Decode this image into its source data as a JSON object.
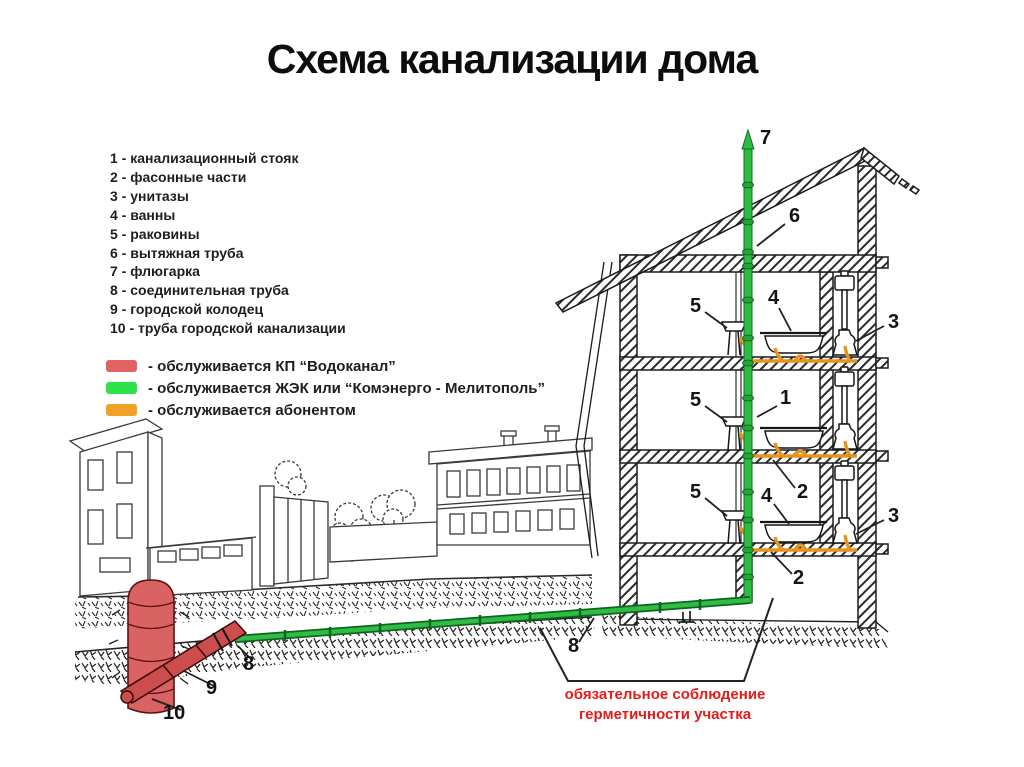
{
  "title": "Схема канализации дома",
  "legend": {
    "items": [
      "1 - канализационный стояк",
      "2 - фасонные части",
      "3 - унитазы",
      "4 - ванны",
      "5 - раковины",
      "6 - вытяжная труба",
      "7 - флюгарка",
      "8 - соединительная труба",
      "9 - городской колодец",
      "10 - труба городской канализации"
    ]
  },
  "service_legend": {
    "items": [
      {
        "color": "#e06262",
        "label": "- обслуживается КП “Водоканал”"
      },
      {
        "color": "#2ee24a",
        "label": "- обслуживается ЖЭК или “Комэнерго - Мелитополь”"
      },
      {
        "color": "#f0a226",
        "label": "- обслуживается абонентом"
      }
    ]
  },
  "numbers": {
    "n1": "1",
    "n2": "2",
    "n3": "3",
    "n4": "4",
    "n5": "5",
    "n6": "6",
    "n7": "7",
    "n8": "8",
    "n9": "9",
    "n10": "10"
  },
  "caption": {
    "line1": "обязательное соблюдение",
    "line2": "герметичности участка"
  },
  "colors": {
    "stack_green": "#2dbb41",
    "pipe_green_dark": "#0e6420",
    "branch_orange": "#e8941c",
    "well_red": "#d96363",
    "city_pipe_red": "#cb4d4d",
    "caption_red": "#e31b1b"
  }
}
